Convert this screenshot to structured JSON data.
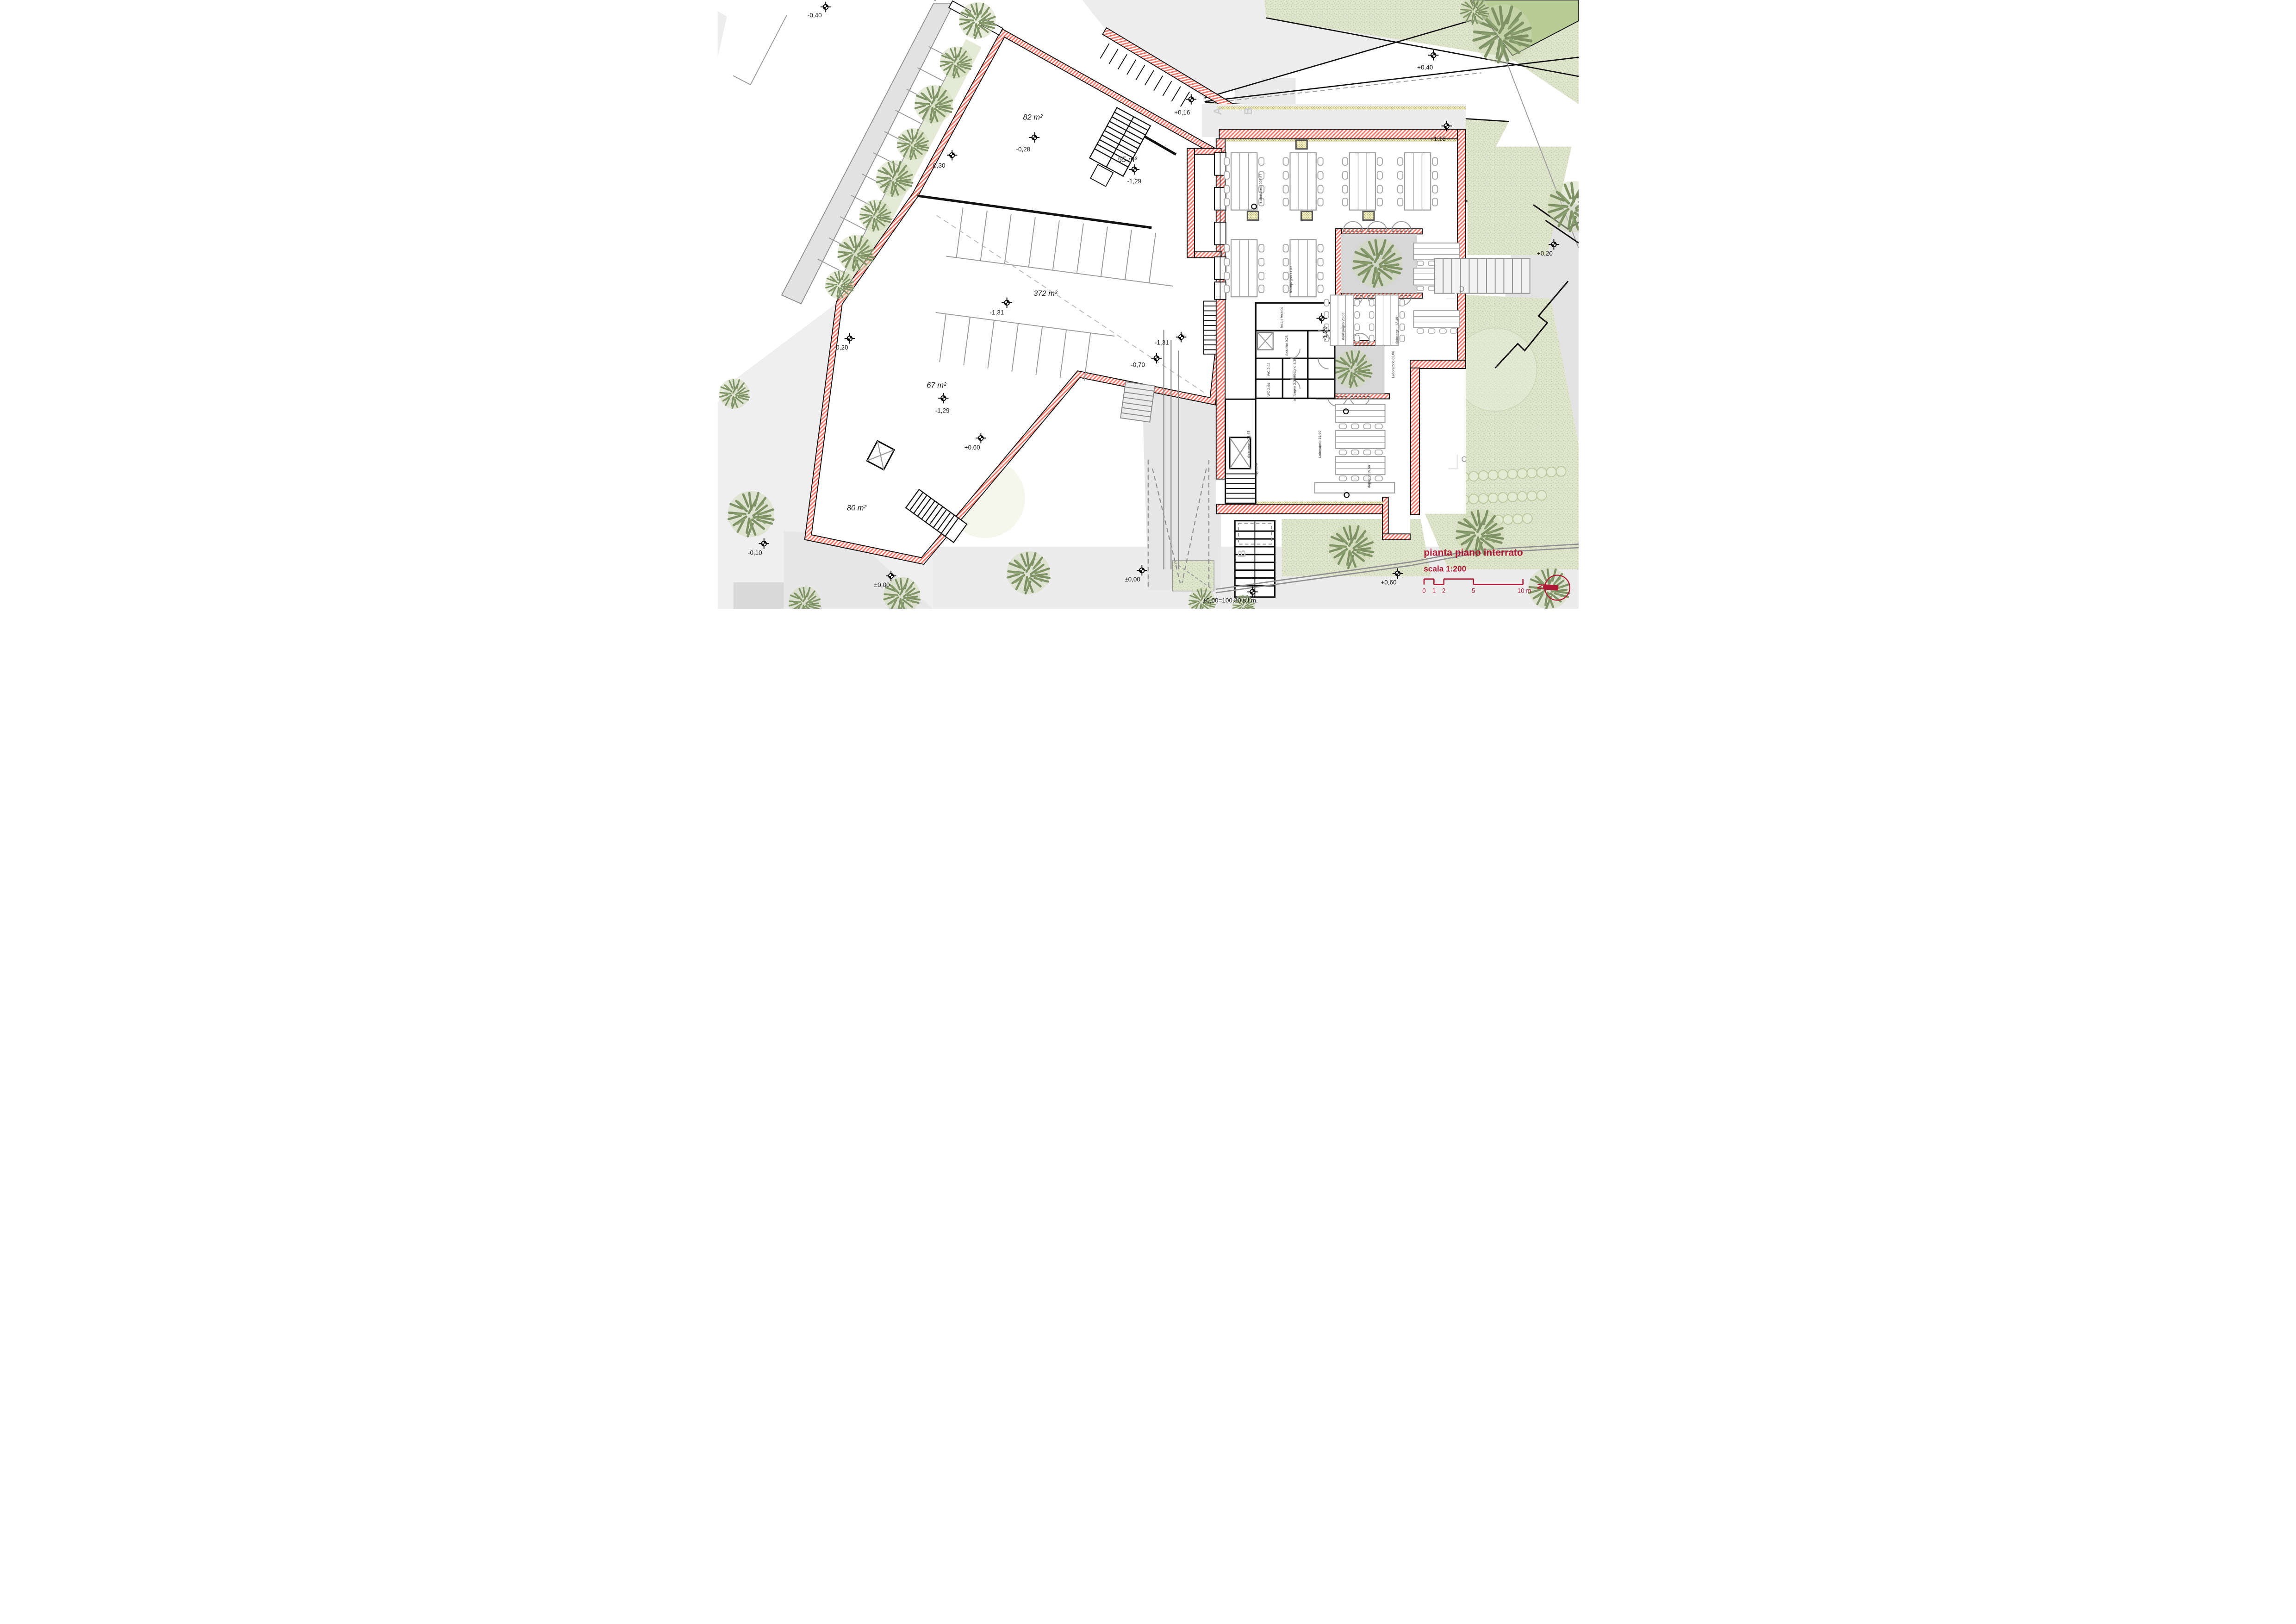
{
  "title": {
    "name": "pianta piano interrato",
    "scale": "scala 1:200"
  },
  "scalebar": {
    "labels": [
      "0",
      "1",
      "2",
      "5",
      "10 m"
    ]
  },
  "north": {
    "label": "N"
  },
  "areas": [
    {
      "label": "82 m²"
    },
    {
      "label": "55 m²"
    },
    {
      "label": "372 m²"
    },
    {
      "label": "67 m²"
    },
    {
      "label": "80 m²"
    }
  ],
  "levels": [
    {
      "v": "-0,40"
    },
    {
      "v": "+0,16"
    },
    {
      "v": "+0,40"
    },
    {
      "v": "+1,16"
    },
    {
      "v": "-0,30"
    },
    {
      "v": "-0,28"
    },
    {
      "v": "-1,29"
    },
    {
      "v": "-1,31"
    },
    {
      "v": "-0,20"
    },
    {
      "v": "-1,29"
    },
    {
      "v": "+0,60"
    },
    {
      "v": "-1,31"
    },
    {
      "v": "-0,70"
    },
    {
      "v": "-1,29"
    },
    {
      "v": "+0,20"
    },
    {
      "v": "-0,10"
    },
    {
      "v": "±0,00"
    },
    {
      "v": "±0,00"
    },
    {
      "v": "+0,60"
    },
    {
      "v": "±0,00=100,80 s.l.m."
    }
  ],
  "rooms": [
    {
      "v": "locale tecnico"
    },
    {
      "v": "deposito 9,28"
    },
    {
      "v": "WC 2,44"
    },
    {
      "v": "WC 2,44"
    },
    {
      "v": "antibagno 3,38"
    },
    {
      "v": "antibagno 3,34"
    },
    {
      "v": "disimpegno 23,88"
    },
    {
      "v": "disimpegno 21,88"
    },
    {
      "v": "disimpegno 12,46"
    },
    {
      "v": "disimpegno 11,62"
    },
    {
      "v": "rip. 1,98"
    },
    {
      "v": "Laboratorio 297,87"
    },
    {
      "v": "Laboratorio 86,06"
    },
    {
      "v": "Laboratorio 31,60"
    },
    {
      "v": "deposito 19,56"
    }
  ],
  "sections": [
    {
      "v": "A"
    },
    {
      "v": "B"
    },
    {
      "v": "B"
    },
    {
      "v": "C"
    },
    {
      "v": "D"
    }
  ],
  "colors": {
    "wall_hatch": "#f2796b",
    "accent_red": "#ae1935",
    "lawn": "#dfe5cc",
    "tree": "#7e9266",
    "road_gray": "#e2e2e2",
    "insulation_olive": "#a59d22"
  }
}
